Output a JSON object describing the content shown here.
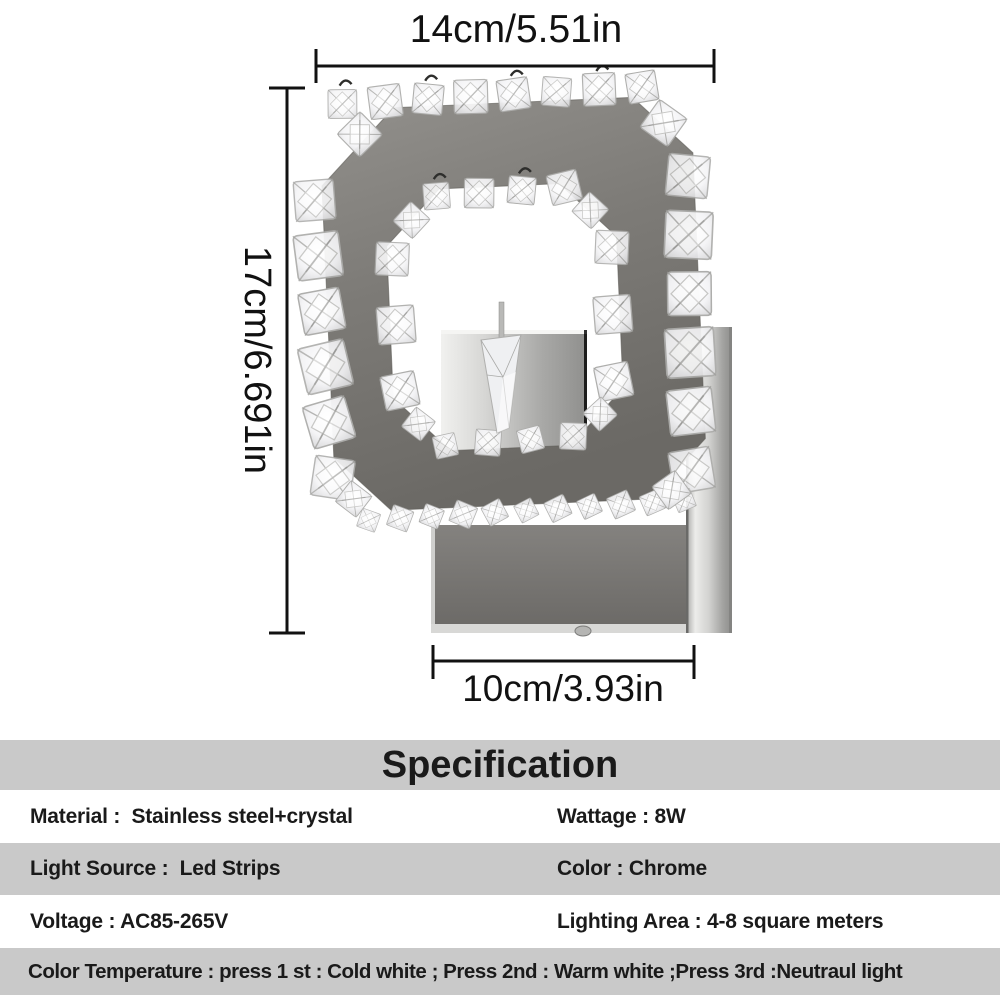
{
  "dimensions": {
    "width_label": "14cm/5.51in",
    "height_label": "17cm/6.691in",
    "base_width_label": "10cm/3.93in"
  },
  "specification": {
    "title": "Specification",
    "rows": [
      {
        "left": "Material :  Stainless steel+crystal",
        "right": "Wattage : 8W"
      },
      {
        "left": "Light Source :  Led Strips",
        "right": "Color : Chrome"
      },
      {
        "left": "Voltage : AC85-265V",
        "right": "Lighting Area : 4-8 square meters"
      },
      {
        "full": "Color Temperature : press 1 st : Cold white ; Press 2nd : Warm white ;Press 3rd :Neutraul light"
      }
    ]
  },
  "colors": {
    "band_gray": "#c9c9c9",
    "text_color": "#1a1a1a",
    "line_color": "#111111",
    "chrome_dark": "#6b6965",
    "chrome_mid": "#8f8d89",
    "chrome_light": "#ececea",
    "crystal_edge": "#b5b5b3"
  }
}
